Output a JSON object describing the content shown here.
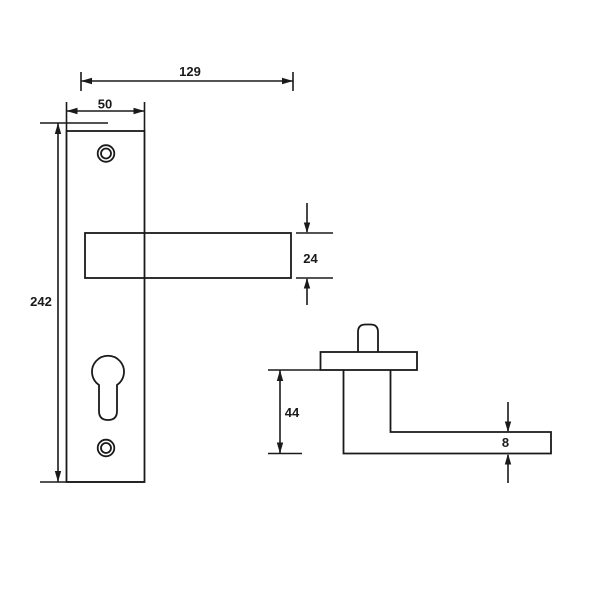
{
  "drawing": {
    "background_color": "#ffffff",
    "line_color": "#1a1a1a",
    "dimensions": {
      "overall_width": "129",
      "plate_width": "50",
      "plate_height": "242",
      "lever_thickness": "24",
      "handle_height": "44",
      "grip_thickness": "8"
    }
  }
}
